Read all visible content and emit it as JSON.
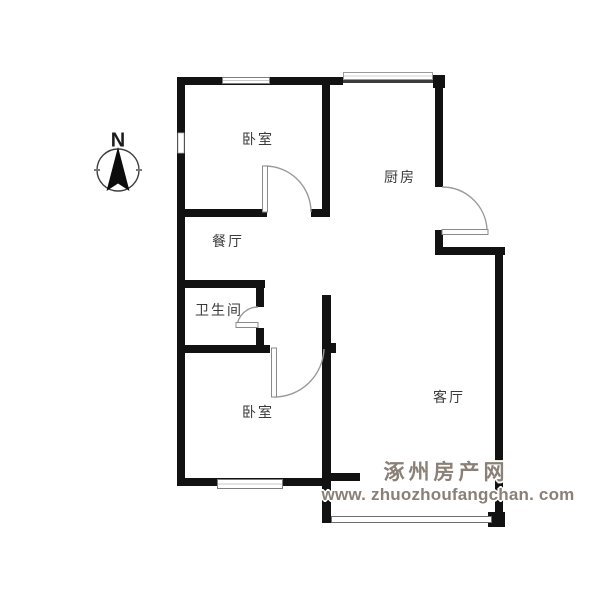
{
  "compass": {
    "label": "N"
  },
  "rooms": [
    {
      "name": "bedroom-north",
      "label": "卧室"
    },
    {
      "name": "kitchen",
      "label": "厨房"
    },
    {
      "name": "dining-room",
      "label": "餐厅"
    },
    {
      "name": "bathroom",
      "label": "卫生间"
    },
    {
      "name": "bedroom-south",
      "label": "卧室"
    },
    {
      "name": "living-room",
      "label": "客厅"
    }
  ],
  "watermark": {
    "site_name": "涿州房产网",
    "site_url": "www. zhuozhoufangchan. com"
  },
  "colors": {
    "background": "#ffffff",
    "wall": "#121212",
    "window_frame": "#7d7d7d",
    "window_mid_line": "#c9c9c9",
    "door_arc": "#9a9a9a",
    "label_text": "#3a3a3a",
    "watermark_gray": "#8a8077"
  }
}
